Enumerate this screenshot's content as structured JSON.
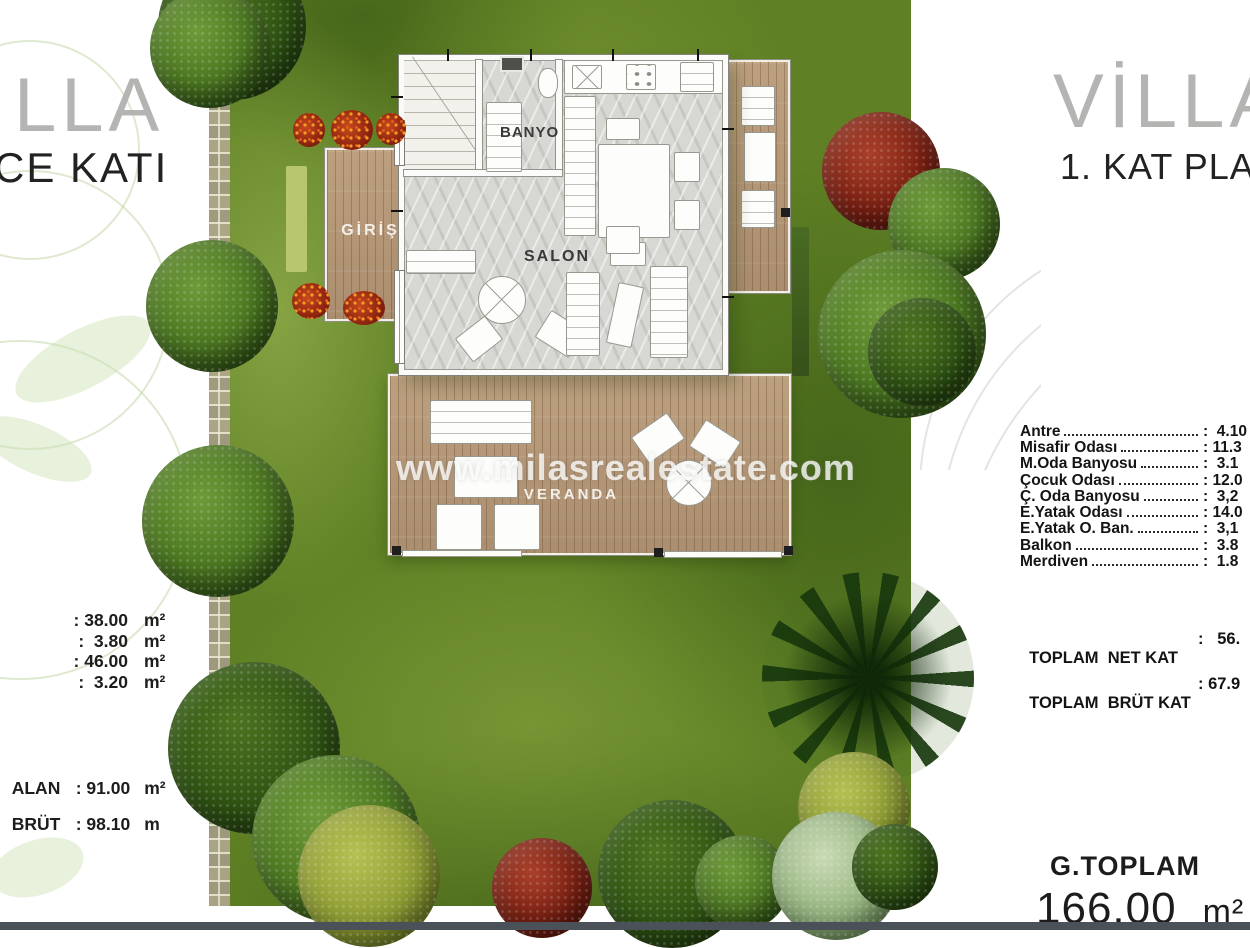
{
  "left_panel": {
    "title_partial": "LLA",
    "subtitle_partial": "CE KATI",
    "areas": [
      {
        "value": ": 38.00",
        "unit": "m²"
      },
      {
        "value": ":  3.80",
        "unit": "m²"
      },
      {
        "value": ": 46.00",
        "unit": "m²"
      },
      {
        "value": ":  3.20",
        "unit": "m²"
      }
    ],
    "totals": [
      {
        "label": "ALAN",
        "value": ": 91.00",
        "unit": "m²"
      },
      {
        "label": "BRÜT",
        "value": ": 98.10",
        "unit": "m"
      }
    ]
  },
  "right_panel": {
    "title": "VİLLA",
    "subtitle": "1. KAT PLA",
    "rooms": [
      {
        "label": "Antre",
        "value": ":  4.10"
      },
      {
        "label": "Misafir Odası",
        "value": ": 11.3"
      },
      {
        "label": "M.Oda Banyosu",
        "value": ":  3.1"
      },
      {
        "label": "Çocuk Odası",
        "value": ": 12.0"
      },
      {
        "label": "Ç. Oda Banyosu",
        "value": ":  3,2"
      },
      {
        "label": "E.Yatak Odası",
        "value": ": 14.0"
      },
      {
        "label": "E.Yatak O. Ban.",
        "value": ":  3,1"
      },
      {
        "label": "Balkon",
        "value": ":  3.8"
      },
      {
        "label": "Merdiven",
        "value": ":  1.8"
      }
    ],
    "totals": [
      {
        "label": "TOPLAM  NET KAT",
        "value": ":   56."
      },
      {
        "label": "TOPLAM  BRÜT KAT",
        "value": ": 67.9"
      }
    ],
    "grand_total": {
      "label": "G.TOPLAM",
      "value": "166.00",
      "unit": "m²"
    }
  },
  "floor_plan": {
    "bathroom_label": "BANYO",
    "living_label": "SALON",
    "entrance_label": "GİRİŞ",
    "veranda_label": "VERANDA"
  },
  "watermark": "www.milasrealestate.com",
  "colors": {
    "grass": "#5f8024",
    "wood": "#b5987a",
    "tree_green": "#4e7a22",
    "tree_red": "#7c2012",
    "title_gray": "#b4b4b2",
    "bottom_bar": "#4b5158"
  }
}
